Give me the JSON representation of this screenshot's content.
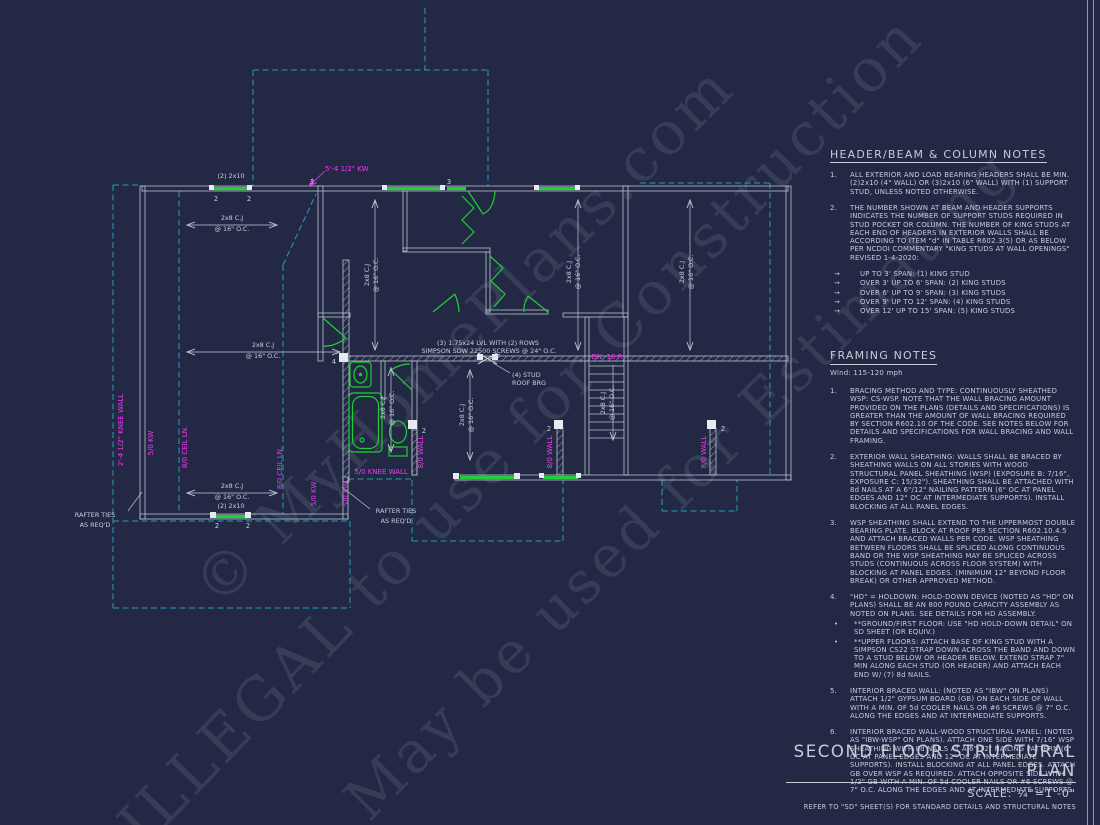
{
  "sheet": {
    "title": "SECOND FLOOR STRUCTURAL PLAN",
    "scale_label": "SCALE: ¼\"=1'-0\"",
    "refer_note": "REFER TO \"SD\" SHEET(S) FOR STANDARD DETAILS AND STRUCTURAL NOTES"
  },
  "watermarks": {
    "line1": "© MyHomePlans.com",
    "line2": "ILLEGAL to use for Construction",
    "line3": "May be used for Estimating"
  },
  "icons": {
    "bullet_arrow": "→",
    "bullet_dot": "•"
  },
  "header_notes": {
    "title": "HEADER/BEAM & COLUMN NOTES",
    "items": [
      {
        "num": "1.",
        "text": "ALL EXTERIOR AND LOAD BEARING HEADERS SHALL BE MIN. (2)2x10 (4\" WALL) OR (3)2x10 (6\" WALL) WITH (1) SUPPORT STUD, UNLESS NOTED OTHERWISE."
      },
      {
        "num": "2.",
        "text": "THE NUMBER SHOWN AT BEAM AND HEADER SUPPORTS INDICATES THE NUMBER OF SUPPORT STUDS REQUIRED IN STUD POCKET OR COLUMN. THE NUMBER OF KING STUDS AT EACH END OF HEADERS IN EXTERIOR WALLS SHALL BE ACCORDING TO ITEM \"d\" IN TABLE R602.3(5) OR AS BELOW PER NCDOI COMMENTARY \"KING STUDS AT WALL OPENINGS\" REVISED 1-4-2020:"
      }
    ],
    "bullets": [
      "UP TO 3' SPAN: (1) KING STUD",
      "OVER 3' UP TO 6' SPAN: (2) KING STUDS",
      "OVER 6' UP TO 9' SPAN: (3) KING STUDS",
      "OVER 9' UP TO 12' SPAN: (4) KING STUDS",
      "OVER 12' UP TO 15' SPAN: (5) KING STUDS"
    ]
  },
  "framing_notes": {
    "title": "FRAMING NOTES",
    "wind": "Wind: 115-120 mph",
    "items": [
      {
        "num": "1.",
        "text": "BRACING METHOD AND TYPE: CONTINUOUSLY SHEATHED WSP: CS-WSP. NOTE THAT THE WALL BRACING AMOUNT PROVIDED ON THE PLANS (DETAILS AND SPECIFICATIONS) IS GREATER THAN THE AMOUNT OF WALL BRACING REQUIRED BY SECTION R602.10 OF THE CODE. SEE NOTES BELOW FOR DETAILS AND SPECIFICATIONS FOR WALL BRACING AND WALL FRAMING."
      },
      {
        "num": "2.",
        "text": "EXTERIOR WALL SHEATHING: WALLS SHALL BE BRACED BY SHEATHING WALLS ON ALL STORIES WITH WOOD STRUCTURAL PANEL SHEATHING (WSP) (EXPOSURE B: 7/16\", EXPOSURE C: 15/32\"). SHEATHING SHALL BE ATTACHED WITH 8d NAILS AT A 6\"/12\" NAILING PATTERN (6\" OC AT PANEL EDGES AND 12\" OC AT INTERMEDIATE SUPPORTS). INSTALL BLOCKING AT ALL PANEL EDGES."
      },
      {
        "num": "3.",
        "text": "WSP SHEATHING SHALL EXTEND TO THE UPPERMOST DOUBLE BEARING PLATE. BLOCK AT ROOF PER SECTION R602.10.4.5 AND ATTACH BRACED WALLS PER CODE. WSP SHEATHING BETWEEN FLOORS SHALL BE SPLICED ALONG CONTINUOUS BAND OR THE WSP SHEATHING MAY BE SPLICED ACROSS STUDS (CONTINUOUS ACROSS FLOOR SYSTEM) WITH BLOCKING AT PANEL EDGES. (MINIMUM 12\" BEYOND FLOOR BREAK) OR OTHER APPROVED METHOD."
      },
      {
        "num": "4.",
        "text": "\"HD\" = HOLDOWN: HOLD-DOWN DEVICE (NOTED AS \"HD\" ON PLANS) SHALL BE AN 800 POUND CAPACITY ASSEMBLY AS NOTED ON PLANS. SEE DETAILS FOR HD ASSEMBLY.",
        "bullets": [
          "**GROUND/FIRST FLOOR:  USE \"HD HOLD-DOWN DETAIL\" ON SD SHEET (OR EQUIV.)",
          "**UPPER FLOORS: ATTACH BASE OF KING STUD WITH A SIMPSON CS22 STRAP DOWN ACROSS THE BAND AND DOWN TO A STUD BELOW OR HEADER BELOW.  EXTEND STRAP 7\" MIN ALONG EACH STUD (OR HEADER) AND ATTACH EACH END W/ (7) 8d NAILS."
        ]
      },
      {
        "num": "5.",
        "text": "INTERIOR BRACED WALL: (NOTED AS \"IBW\" ON PLANS) ATTACH 1/2\" GYPSUM BOARD (GB) ON EACH SIDE OF WALL WITH A MIN. OF 5d COOLER NAILS OR #6 SCREWS @ 7\" O.C. ALONG THE EDGES AND AT INTERMEDIATE SUPPORTS."
      },
      {
        "num": "6.",
        "text": "INTERIOR BRACED WALL-WOOD STRUCTURAL PANEL: (NOTED AS \"IBW-WSP\" ON PLANS). ATTACH ONE SIDE WITH 7/16\" WSP SHEATHING WITH 8d NAILS AT A 6\"/12\" NAILING PATTERN (6\" OC AT PANEL EDGES AND 12\" OC AT INTERMEDIATE SUPPORTS). INSTALL BLOCKING AT ALL PANEL EDGES. ATTACH GB OVER WSP AS REQUIRED. ATTACH OPPOSITE SIDE WITH 1/2\" GB WITH A MIN. OF 5d COOLER NAILS OR #6 SCREWS @ 7\" O.C. ALONG THE EDGES AND AT INTERMEDIATE SUPPORTS."
      }
    ]
  },
  "plan": {
    "labels": {
      "lvl1": "(3) 1.75x24 LVL WITH (2) ROWS",
      "lvl2": "SIMPSON SDW 22500 SCREWS @ 24\" O.C.",
      "stud_roof1": "(4) STUD",
      "stud_roof2": "ROOF BRG",
      "cj": "2x8 C.J",
      "oc16": "@ 16\" O.C.",
      "header_2x10": "(2) 2x10",
      "kw_dim": "5'-4 1/2\" KW",
      "knee_wall_dim": "2'-4 1/2\" KNEE WALL",
      "kw50": "5/0 KW",
      "ceil80": "8/0 CEIL LN.",
      "knee_wall50": "5/0 KNEE WALL",
      "wall80": "8/0 WALL",
      "dn": "DN. 16 R",
      "rafter1": "RAFTER TIES",
      "rafter2": "AS REQ'D",
      "n2": "2",
      "n3": "3",
      "n4": "4"
    },
    "colors": {
      "wall": "#b9c1ce",
      "ceiling_dashed": "#22a0b8",
      "framing_green": "#1fcf35",
      "annotation_magenta": "#ee3cee",
      "background": "#232945"
    }
  }
}
